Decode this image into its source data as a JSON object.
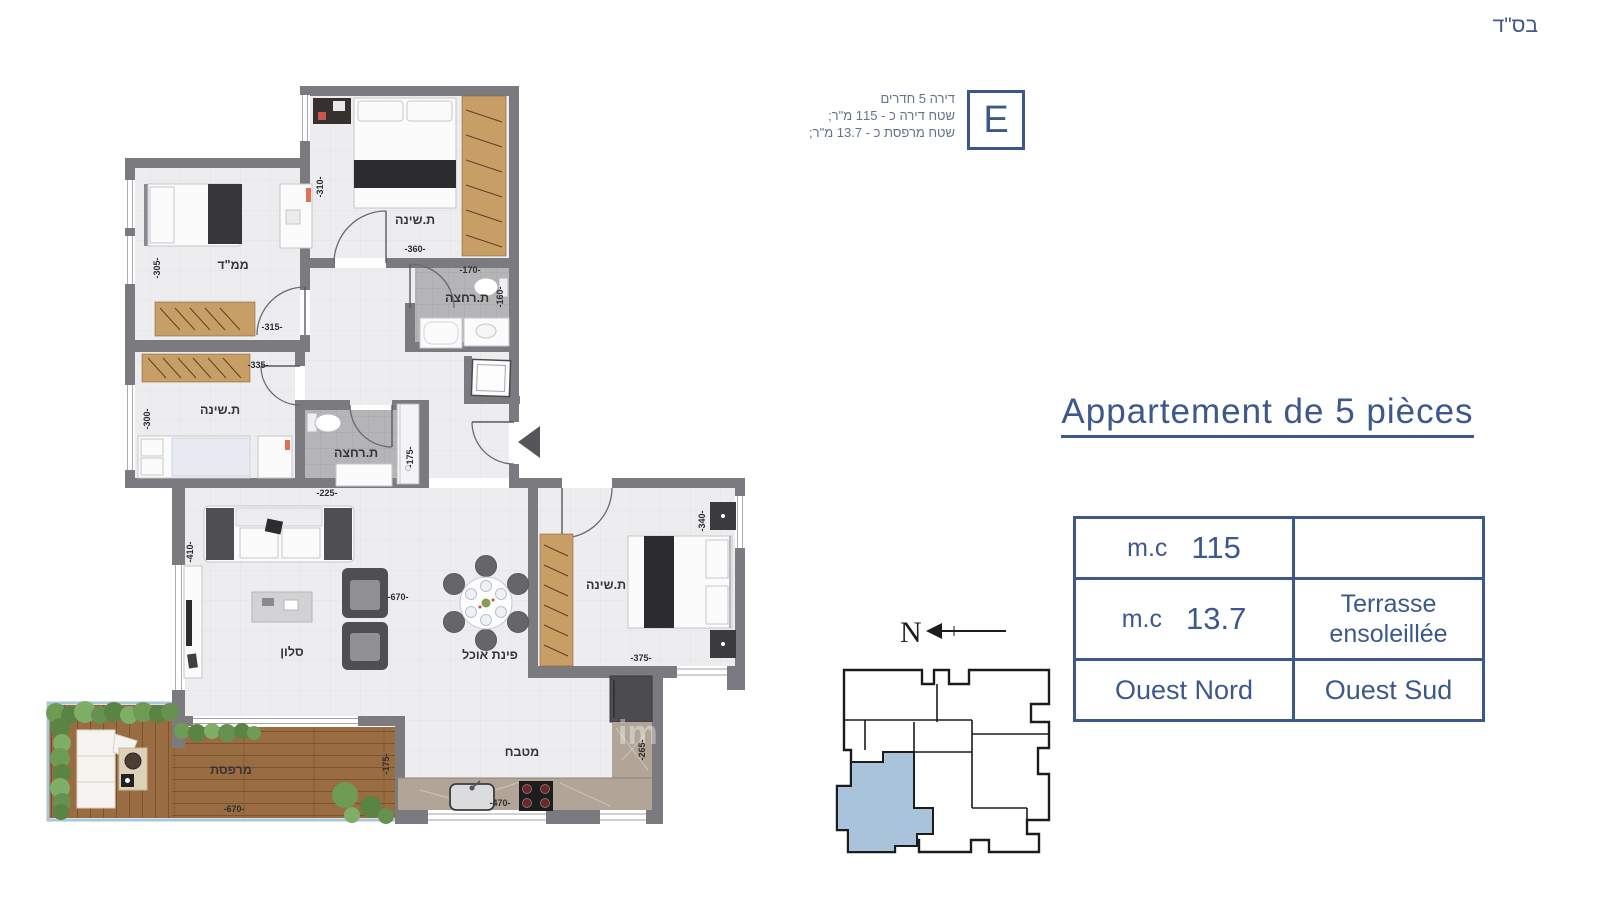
{
  "page": {
    "bsd": "בס\"ד",
    "watermark": "im"
  },
  "unit": {
    "badge": "E",
    "info_line1": "דירה 5 חדרים",
    "info_line2": "שטח דירה כ - 115 מ\"ר;",
    "info_line3": "שטח מרפסת כ - 13.7 מ\"ר;"
  },
  "title": "Appartement de 5 pièces",
  "table": {
    "r1c1_unit": "m.c",
    "r1c1_value": "115",
    "r1c2": "",
    "r2c1_unit": "m.c",
    "r2c1_value": "13.7",
    "r2c2_line1": "Terrasse",
    "r2c2_line2": "ensoleillée",
    "r3c1": "Ouest Nord",
    "r3c2": "Ouest Sud"
  },
  "compass": {
    "label": "N"
  },
  "plan": {
    "bedroom_top": {
      "label": "ת.שינה",
      "w": "-360-",
      "h": "-310-"
    },
    "mamad": {
      "label": "ממ\"ד",
      "w": "-315-",
      "h": "-305-"
    },
    "bath_top": {
      "label": "ת.רחצה",
      "w": "-170-",
      "h": "-160-"
    },
    "bedroom_left": {
      "label": "ת.שינה",
      "w": "-335-",
      "h": "-300-"
    },
    "bath_mid": {
      "label": "ת.רחצה",
      "w": "-225-",
      "h": "-175-"
    },
    "living": {
      "label": "סלון",
      "w": "-670-",
      "h": "-410-"
    },
    "dining": {
      "label": "פינת אוכל"
    },
    "bedroom_right": {
      "label": "ת.שינה",
      "w": "-375-",
      "h": "-340-"
    },
    "kitchen": {
      "label": "מטבח",
      "w": "-470-",
      "h": "-265-"
    },
    "terrace": {
      "label": "מרפסת",
      "w": "-670-",
      "h": "-175-"
    }
  },
  "colors": {
    "accent": "#3c588c",
    "wall": "#7b7b7f",
    "unit_highlight": "#a9c3da",
    "wood": "#c79e66",
    "deck": "#9a6c42"
  }
}
